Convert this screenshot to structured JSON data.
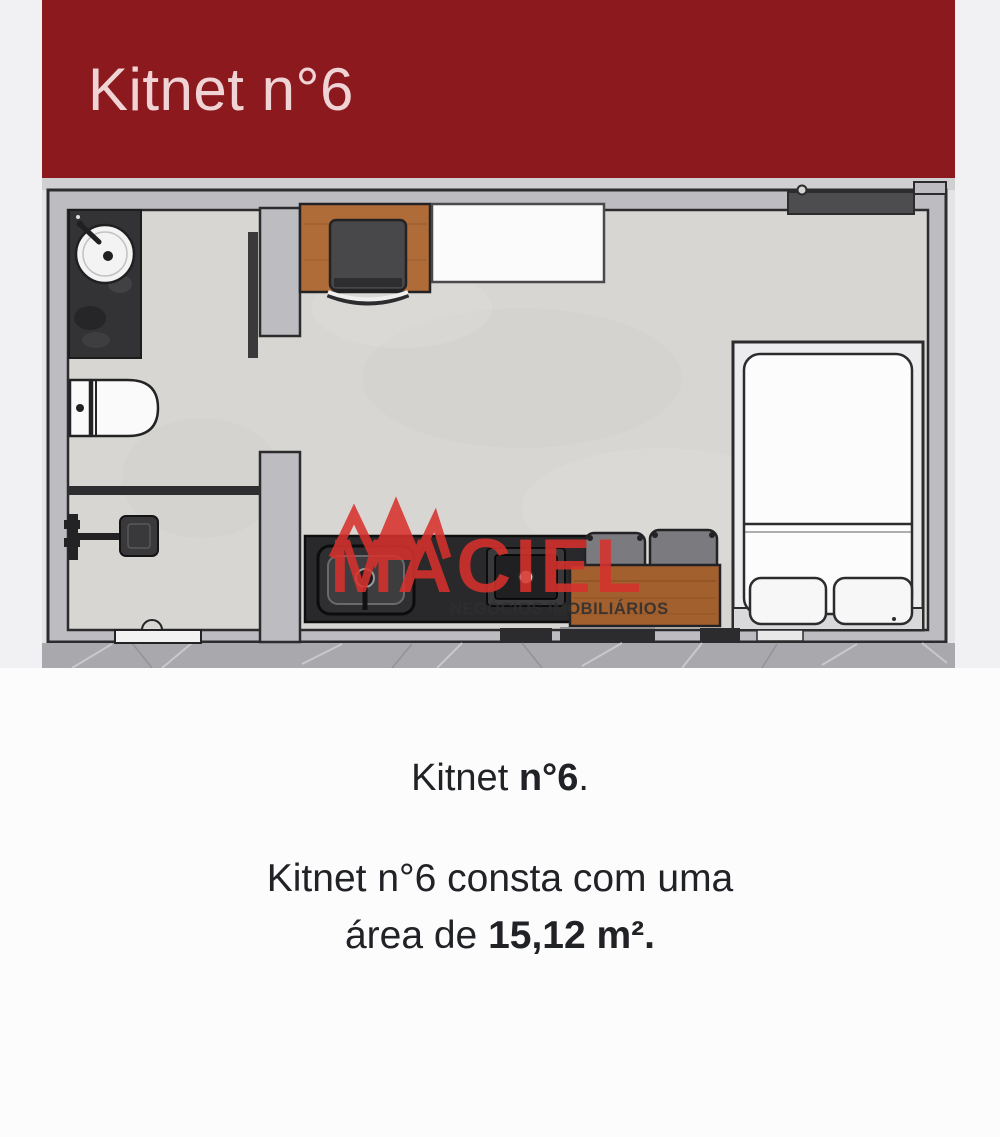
{
  "header": {
    "title": "Kitnet n°6"
  },
  "watermark": {
    "brand": "MACIEL",
    "tagline": "NEGÓCIOS IMOBILIÁRIOS"
  },
  "caption": {
    "title_prefix": "Kitnet ",
    "title_number": "n°6",
    "title_period": ".",
    "body_line1": "Kitnet n°6 consta com uma",
    "body_line2_prefix": "área de ",
    "body_line2_bold": "15,12 m²."
  },
  "colors": {
    "header_background": "#8b191d",
    "header_text": "#f0d4d5",
    "brand_red": "#d7312c",
    "wall_gray": "#bcbcc1",
    "floor_gray": "#d7d6d2",
    "outline_dark": "#2c2c2e",
    "stone_floor": "#a9a9ad"
  }
}
